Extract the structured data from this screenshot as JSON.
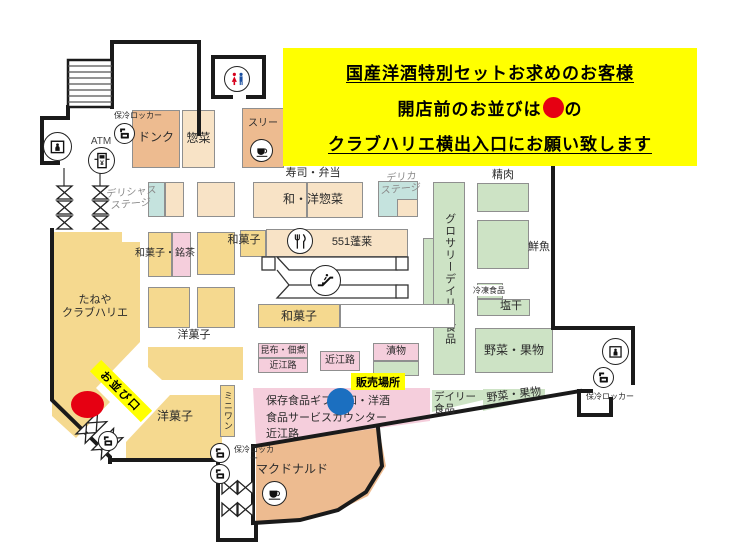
{
  "banner": {
    "line1": "国産洋酒特別セットお求めのお客様",
    "line2_prefix": "開店前のお並びは",
    "line2_suffix": "の",
    "line3": "クラブハリエ横出入口にお願い致します",
    "bg_color": "#FFFF00",
    "dot_color": "#E60012"
  },
  "areas": {
    "donq": "ドンク",
    "sozai": "惣菜",
    "three": "スリー",
    "sushi_bento": "寿司・弁当",
    "wayo_sozai": "和・洋惣菜",
    "delicious_stage": "デリシャス\nステージ",
    "delica_stage": "デリカ\nステージ",
    "wagashi_meicha": "和菓子・銘茶",
    "wagashi_551": "和菓子",
    "horai_551": "551蓬莱",
    "wagashi_mid": "和菓子",
    "yogashi_mid": "洋菓子",
    "taneya": "たねや\nクラブハリエ",
    "grocery": "グロサリーデイリー食品",
    "seiniku": "精肉",
    "sengyo": "鮮魚",
    "reitou": "冷凍食品",
    "shiokan": "塩干",
    "yasai_right": "野菜・果物",
    "yasai_bottom": "野菜・果物",
    "kombu_top": "昆布・佃煮",
    "kombu_bottom": "近江路",
    "omiji": "近江路",
    "tsukemono": "漬物",
    "hozon_counter": "保存食品ギフト 和・洋酒\n食品サービスカウンター\n近江路",
    "daily": "デイリー\n食品",
    "miniwan": "ミニワン",
    "yogashi_bottom": "洋菓子",
    "mcdonalds": "マクドナルド"
  },
  "facilities": {
    "atm": "ATM",
    "locker_top": "保冷ロッカー",
    "locker_bottom": "保冷ロッカー",
    "locker_right": "保冷ロッカー"
  },
  "markers": {
    "sales_point": "販売場所",
    "queue_entrance": "お並び口",
    "red_color": "#E60012",
    "blue_color": "#1B6FC0"
  },
  "icons": {
    "restroom": "restroom-icon",
    "elevator": "elevator-icon",
    "atm": "atm-icon",
    "cold_locker": "cold-locker-icon",
    "escalator": "escalator-icon",
    "restaurant": "fork-knife-icon",
    "cafe": "coffee-cup-icon"
  },
  "colors": {
    "sweets_yellow": "#F5D98F",
    "deli_cream": "#F8E3C6",
    "bakery_salmon": "#EDBB90",
    "fresh_green": "#CDE3C5",
    "gift_pink": "#F5CEDC",
    "stage_teal": "#C5E3DE",
    "wall": "#1A1A1A"
  }
}
